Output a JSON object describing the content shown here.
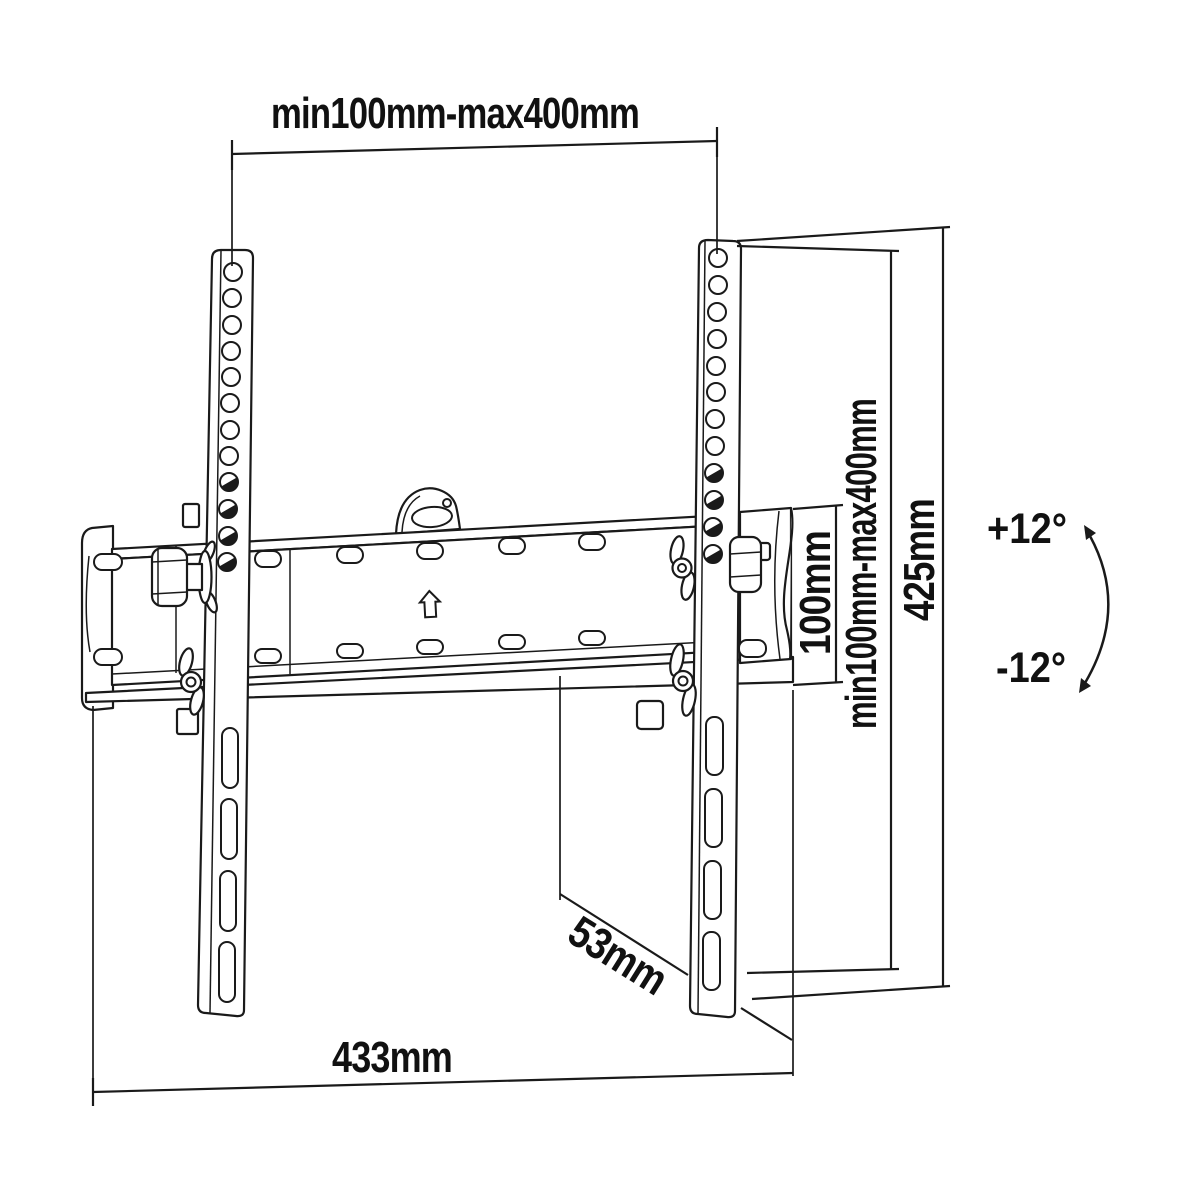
{
  "figure": {
    "background_color": "#ffffff",
    "line_color": "#1a1a1a",
    "text_color": "#111111"
  },
  "labels": {
    "vesa_width_range": "min100mm-max400mm",
    "vesa_height_range": "min100mm-max400mm",
    "bracket_height": "425mm",
    "plate_height": "100mm",
    "wall_clearance": "53mm",
    "plate_width": "433mm",
    "tilt_up": "+12°",
    "tilt_down": "-12°"
  }
}
